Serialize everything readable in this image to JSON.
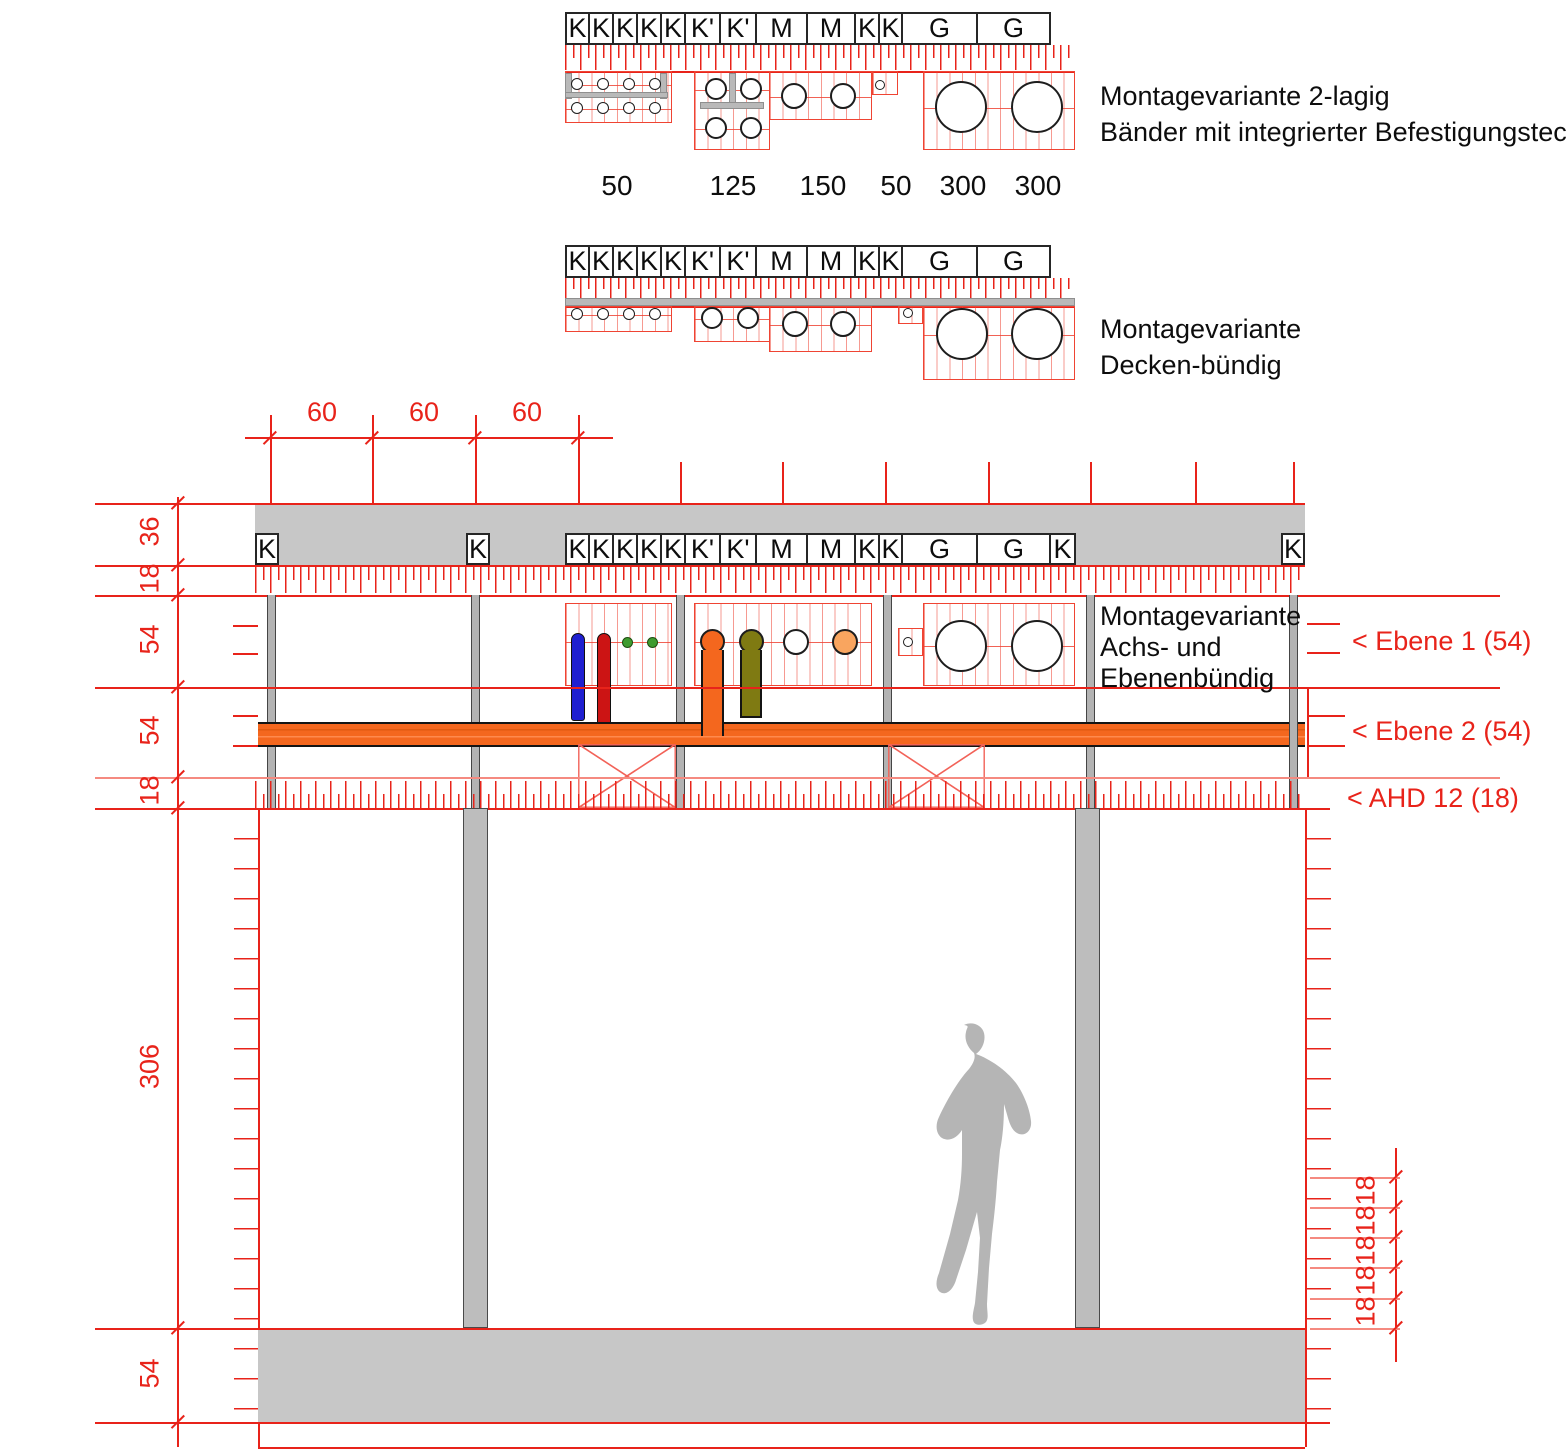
{
  "diagram1": {
    "caption_line1": "Montagevariante 2-lagig",
    "caption_line2": "Bänder mit integrierter Befestigungstechnik",
    "cells": [
      "K",
      "K",
      "K",
      "K",
      "K",
      "K'",
      "K'",
      "M",
      "M",
      "K",
      "K",
      "G",
      "G"
    ],
    "dims": [
      "50",
      "125",
      "150",
      "50",
      "300",
      "300"
    ]
  },
  "diagram2": {
    "caption_line1": "Montagevariante",
    "caption_line2": "Decken-bündig",
    "cells": [
      "K",
      "K",
      "K",
      "K",
      "K",
      "K'",
      "K'",
      "M",
      "M",
      "K",
      "K",
      "G",
      "G"
    ]
  },
  "section": {
    "caption_line1": "Montagevariante",
    "caption_line2": "Achs- und",
    "caption_line3": "Ebenenbündig",
    "cells": [
      "K",
      "K",
      "K",
      "K",
      "K",
      "K'",
      "K'",
      "M",
      "M",
      "K",
      "K",
      "G",
      "G",
      "K"
    ],
    "left_k": "K",
    "mid_k": "K",
    "right_k": "K",
    "top_dims": [
      "60",
      "60",
      "60"
    ],
    "left_dims": [
      "36",
      "18",
      "54",
      "54",
      "18",
      "306",
      "54"
    ],
    "right_dims": [
      "18",
      "18",
      "18",
      "18",
      "18"
    ],
    "levels": [
      "< Ebene 1 (54)",
      "< Ebene 2 (54)",
      "< AHD 12 (18)"
    ]
  },
  "colors": {
    "dim_red": "#e8231a",
    "band_orange": "#f4671e",
    "pipe_blue": "#1f1fd0",
    "pipe_red": "#cc1414",
    "pipe_olive": "#7f7a12",
    "dot_green": "#3f9b2f",
    "fill_light_orange": "#f9a55f",
    "gray": "#c7c7c7"
  }
}
